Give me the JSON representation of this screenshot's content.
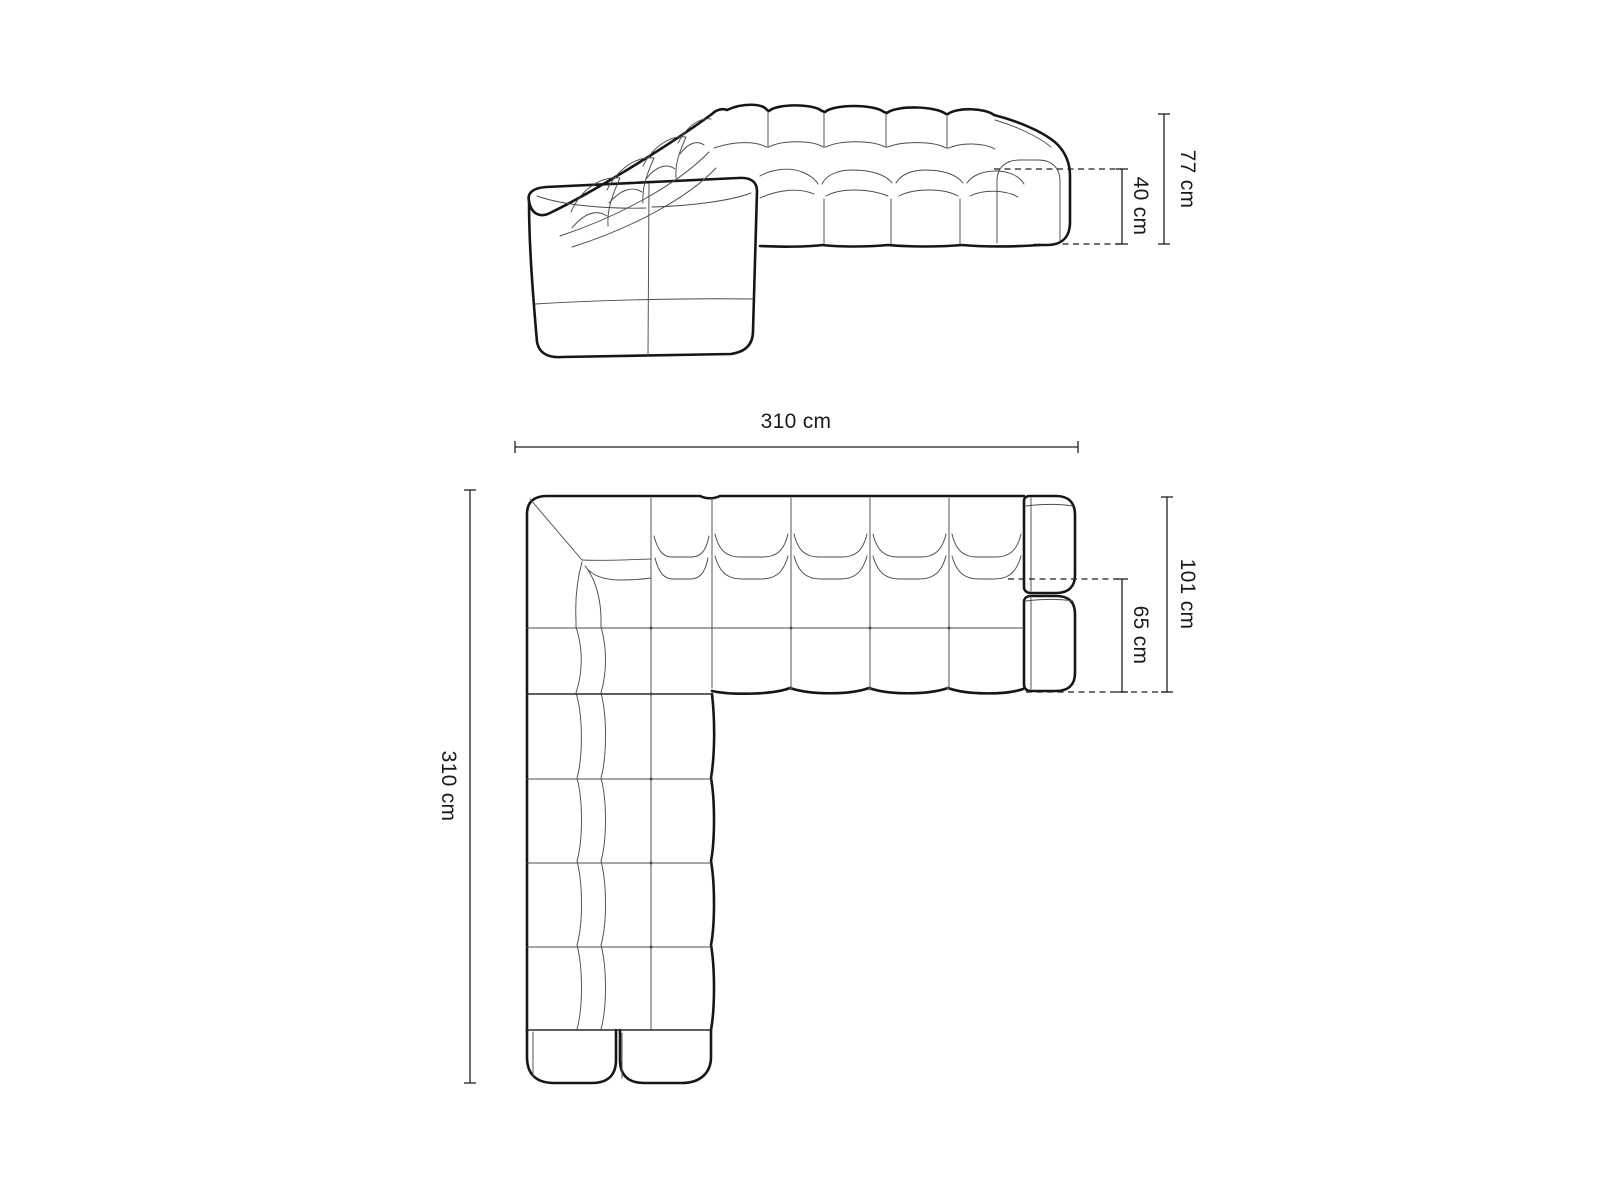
{
  "front_view": {
    "dim_total_height": "77 cm",
    "dim_seat_height": "40 cm"
  },
  "plan_view": {
    "dim_width": "310 cm",
    "dim_depth": "310 cm",
    "dim_total_depth": "101 cm",
    "dim_seat_depth": "65 cm"
  },
  "colors": {
    "background": "#ffffff",
    "line": "#161616",
    "dimension_line": "#1f1f1f"
  }
}
